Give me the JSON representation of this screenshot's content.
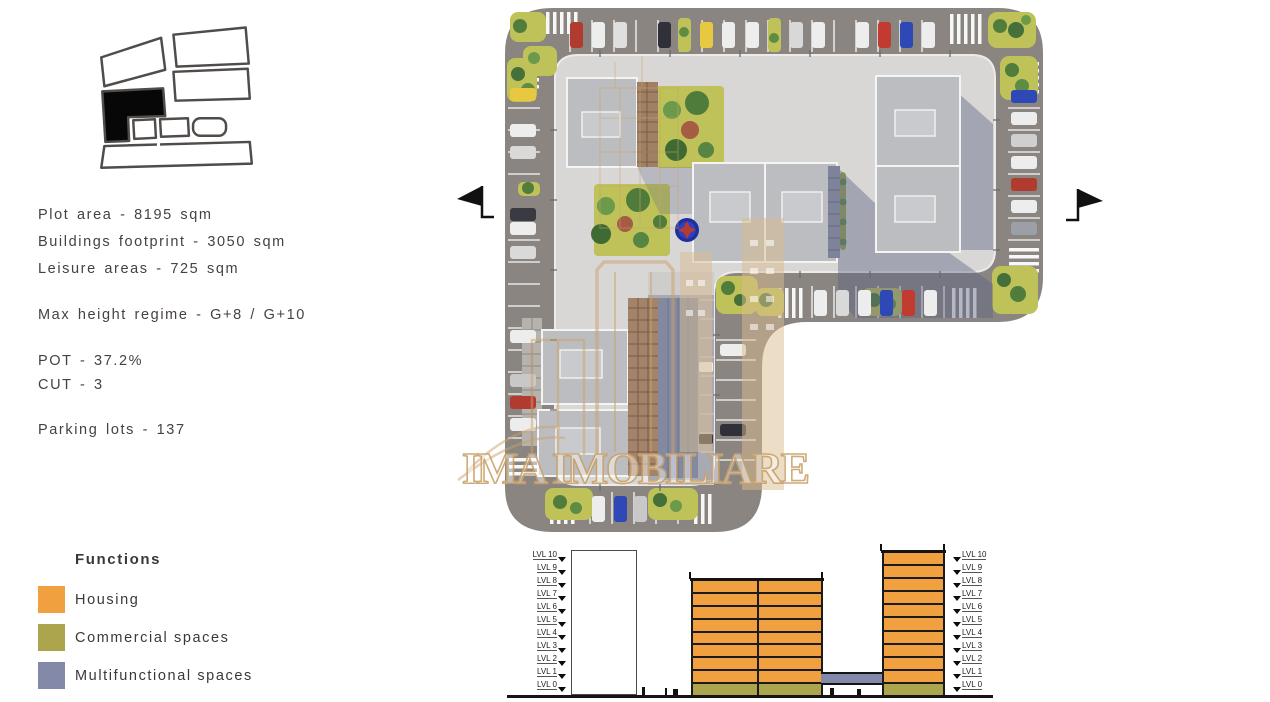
{
  "left_panel": {
    "stats": {
      "plot_area": "Plot area - 8195 sqm",
      "buildings_footprint": "Buildings footprint - 3050 sqm",
      "leisure_areas": "Leisure areas - 725 sqm",
      "max_height": "Max height regime - G+8 / G+10",
      "pot": "POT - 37.2%",
      "cut": "CUT - 3",
      "parking": "Parking lots - 137"
    },
    "legend": {
      "title": "Functions",
      "items": [
        {
          "label": "Housing",
          "color": "#F0A03F"
        },
        {
          "label": "Commercial spaces",
          "color": "#ACA54D"
        },
        {
          "label": "Multifunctional spaces",
          "color": "#8389A9"
        }
      ]
    }
  },
  "site_plan": {
    "watermark": {
      "text": "IMA IMOBILIARE",
      "color": "#C9A26B"
    },
    "icons": {
      "left_marker": "section-flag-left",
      "right_marker": "section-flag-right",
      "fountain": "fountain-compass"
    },
    "colors": {
      "road": "#8A8580",
      "plot": "#D9D7D5",
      "roof": "#BCBDC0",
      "green": "#BEC258",
      "shadow": "#596183",
      "fountain_blue": "#2233A8"
    }
  },
  "elevation": {
    "levels": [
      "LVL 10",
      "LVL 9",
      "LVL 8",
      "LVL 7",
      "LVL 6",
      "LVL 5",
      "LVL 4",
      "LVL 3",
      "LVL 2",
      "LVL 1",
      "LVL 0"
    ],
    "mid_building_top_level": "LVL 8",
    "towers_top_level": "LVL 10",
    "floors": {
      "mid_housing_floors": 8,
      "right_housing_floors": 10,
      "ground_floor_use": "Commercial spaces",
      "bridge_use": "Multifunctional spaces"
    }
  }
}
